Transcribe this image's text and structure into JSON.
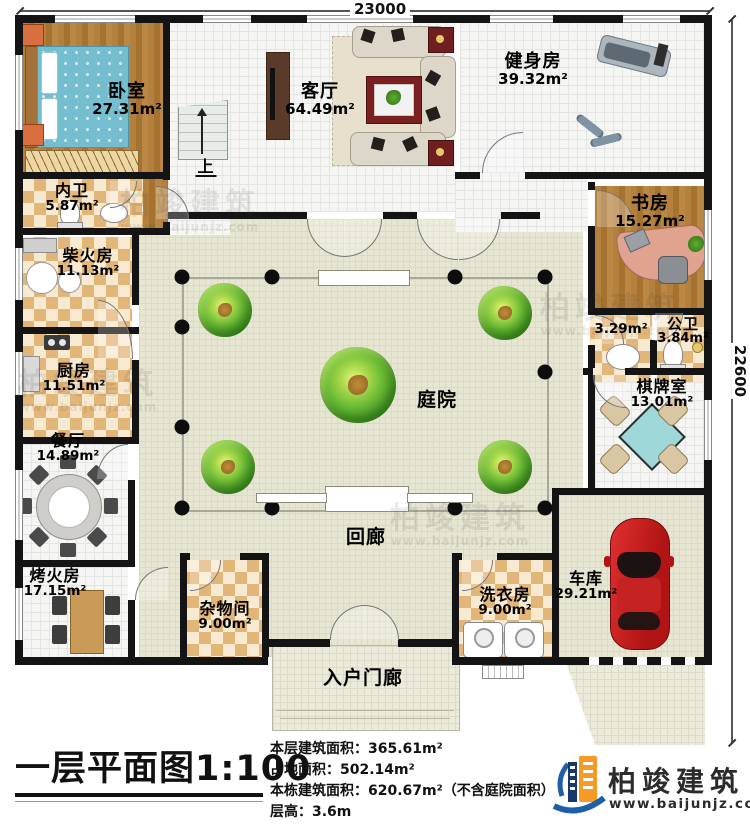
{
  "dims": {
    "width": "23000",
    "height": "22600"
  },
  "rooms": {
    "bedroom": {
      "name": "卧室",
      "area": "27.31m²"
    },
    "living_room": {
      "name": "客厅",
      "area": "64.49m²"
    },
    "gym": {
      "name": "健身房",
      "area": "39.32m²"
    },
    "inner_bath": {
      "name": "内卫",
      "area": "5.87m²"
    },
    "study": {
      "name": "书房",
      "area": "15.27m²"
    },
    "firewood_room": {
      "name": "柴火房",
      "area": "11.13m²"
    },
    "washroom": {
      "area": "3.29m²"
    },
    "public_bath": {
      "name": "公卫",
      "area": "3.84m²"
    },
    "kitchen": {
      "name": "厨房",
      "area": "11.51m²"
    },
    "chess_room": {
      "name": "棋牌室",
      "area": "13.01m²"
    },
    "dining_room": {
      "name": "餐厅",
      "area": "14.89m²"
    },
    "courtyard": {
      "name": "庭院"
    },
    "corridor": {
      "name": "回廊"
    },
    "heating_room": {
      "name": "烤火房",
      "area": "17.15m²"
    },
    "storage_room": {
      "name": "杂物间",
      "area": "9.00m²"
    },
    "laundry_room": {
      "name": "洗衣房",
      "area": "9.00m²"
    },
    "garage": {
      "name": "车库",
      "area": "29.21m²"
    },
    "entry_porch": {
      "name": "入户门廊"
    },
    "stairs": {
      "label": "上"
    }
  },
  "footer": {
    "title": "一层平面图1:100",
    "stats": [
      "本层建筑面积：365.61m²",
      "占地面积：502.14m²",
      "本栋建筑面积：620.67m²（不含庭院面积）",
      "层高：3.6m"
    ],
    "brand": {
      "name": "柏竣建筑",
      "url": "www.baijunjz.com"
    }
  },
  "watermark": {
    "name": "柏竣建筑",
    "url": "www.baijunjz.com"
  }
}
